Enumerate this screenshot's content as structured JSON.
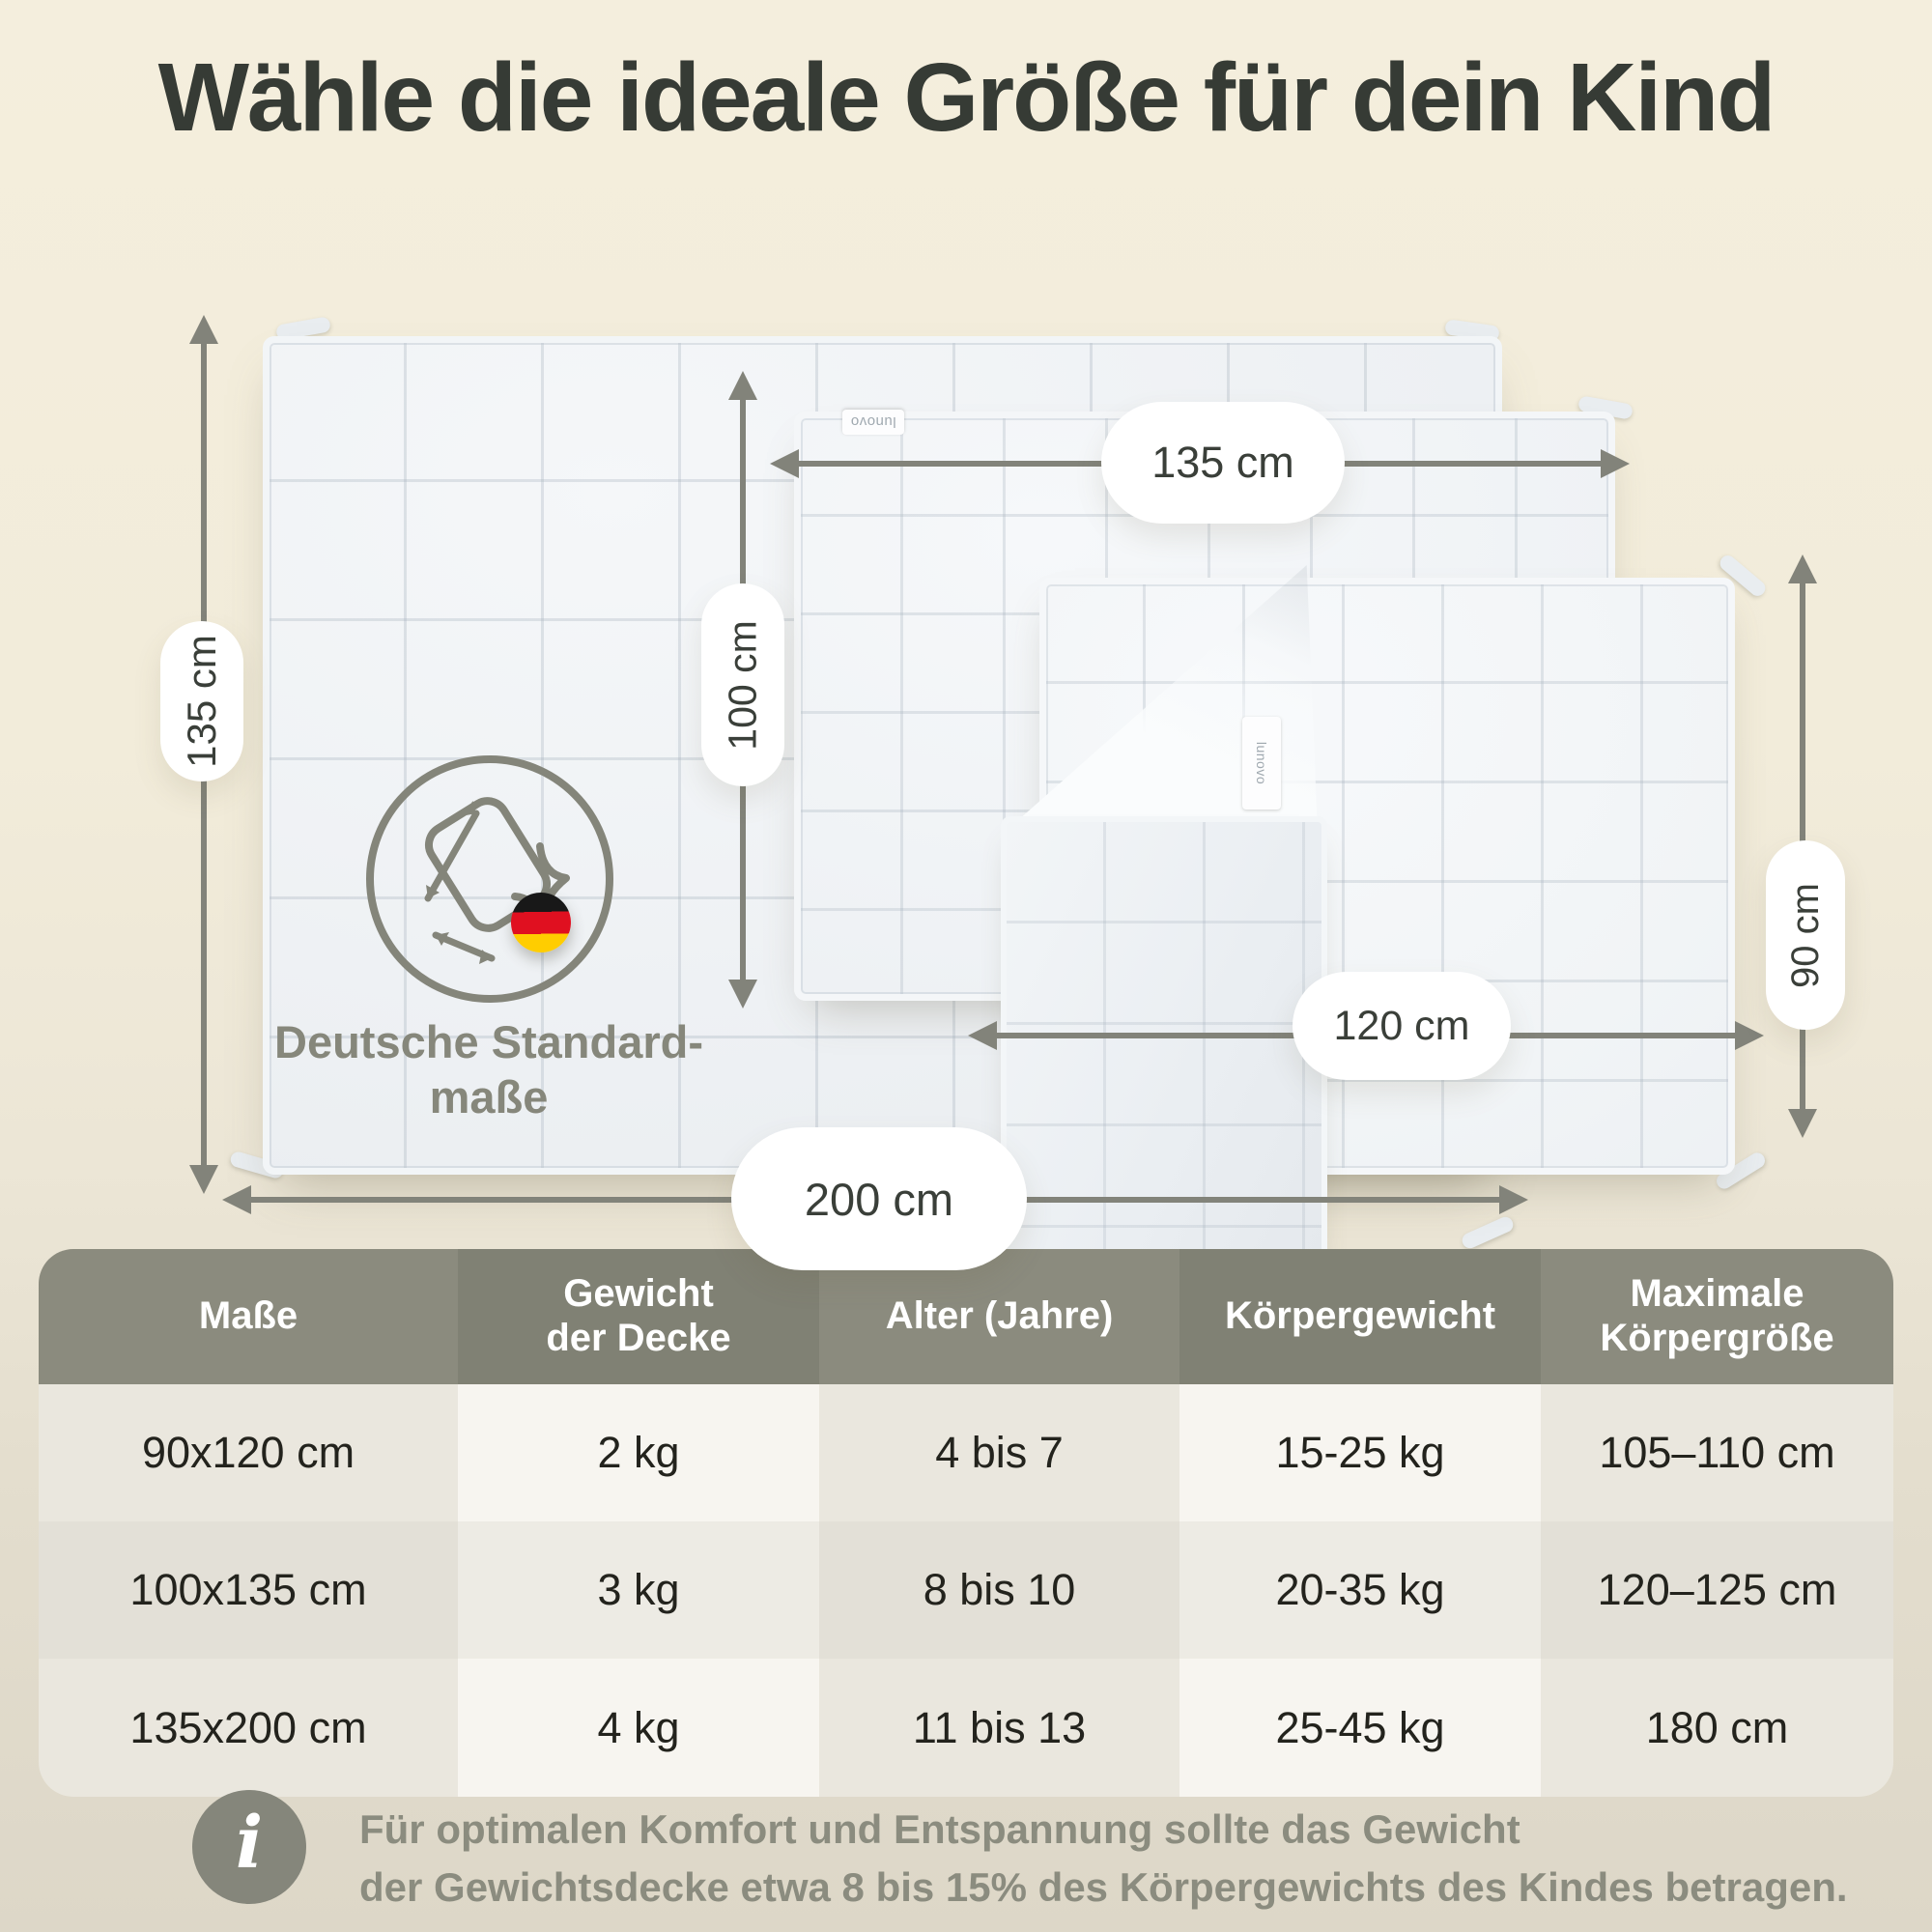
{
  "title": "Wähle die ideale Größe für dein Kind",
  "diagram": {
    "badge": {
      "line1": "Deutsche Standard-",
      "line2": "maße"
    },
    "brand_tag": "lunovo",
    "dimensions": {
      "large_height": "135 cm",
      "large_width": "200 cm",
      "medium_height": "100 cm",
      "medium_width": "135 cm",
      "small_height": "90 cm",
      "small_width": "120 cm"
    }
  },
  "table": {
    "headers": [
      {
        "line1": "Maße",
        "line2": ""
      },
      {
        "line1": "Gewicht",
        "line2": "der Decke"
      },
      {
        "line1": "Alter (Jahre)",
        "line2": ""
      },
      {
        "line1": "Körpergewicht",
        "line2": ""
      },
      {
        "line1": "Maximale",
        "line2": "Körpergröße"
      }
    ],
    "rows": [
      [
        "90x120 cm",
        "2 kg",
        "4 bis 7",
        "15-25 kg",
        "105–110 cm"
      ],
      [
        "100x135 cm",
        "3 kg",
        "8 bis 10",
        "20-35 kg",
        "120–125 cm"
      ],
      [
        "135x200 cm",
        "4 kg",
        "11 bis 13",
        "25-45 kg",
        "180 cm"
      ]
    ]
  },
  "footer": {
    "icon": "i",
    "line1": "Für optimalen Komfort und Entspannung sollte das Gewicht",
    "line2": "der Gewichtsdecke etwa 8 bis 15% des Körpergewichts des Kindes betragen."
  },
  "colors": {
    "background": "#f1ebd9",
    "accent_gray": "#82837a",
    "title_text": "#363b35",
    "table_header_bg": "#8a8b7d",
    "flag_black": "#181818",
    "flag_red": "#e01020",
    "flag_gold": "#ffcd00"
  }
}
